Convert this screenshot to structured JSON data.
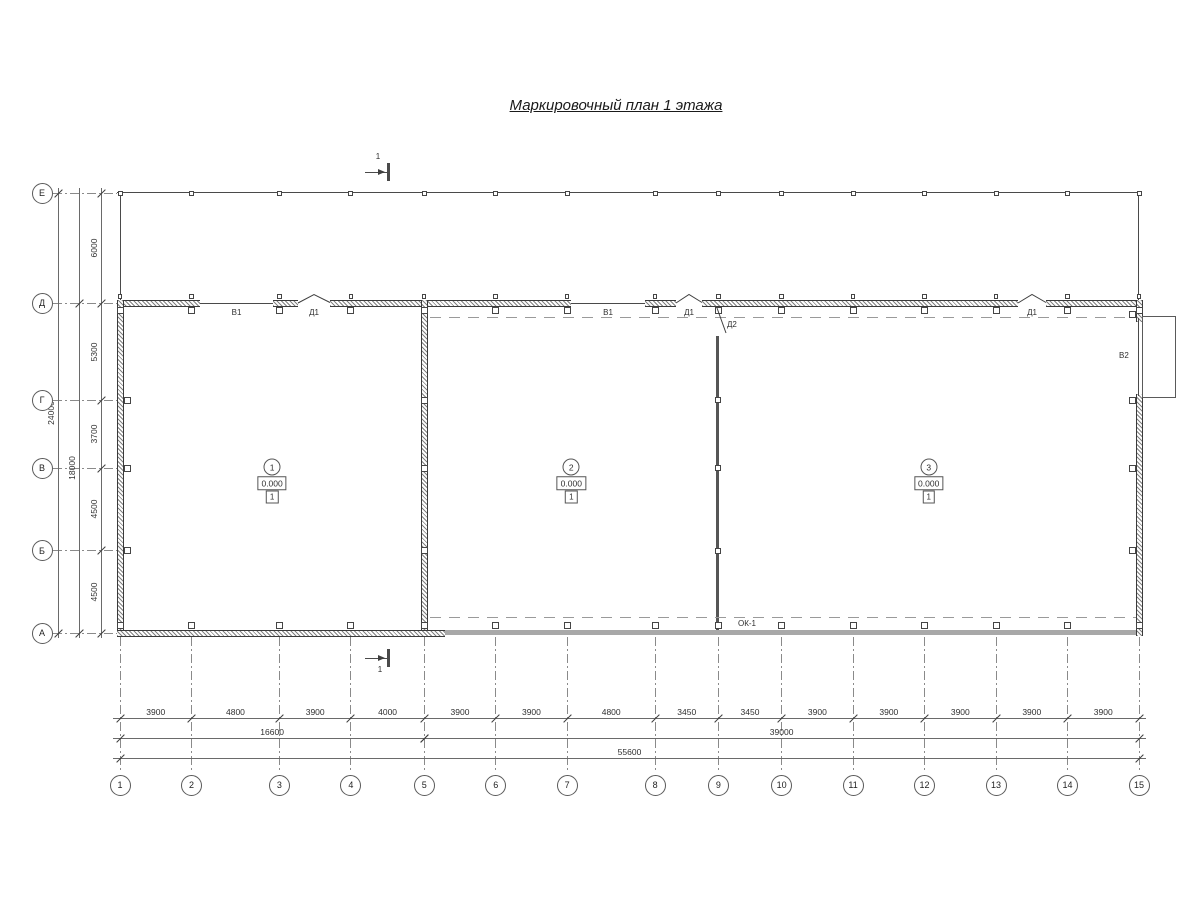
{
  "title": "Маркировочный план 1 этажа",
  "colors": {
    "ink": "#3f3f3f",
    "dim_ink": "#5a5a5a",
    "south_wall_gray": "#a8a8a8",
    "grid_dash": "#8a8a8a"
  },
  "grid": {
    "row_labels": [
      "Е",
      "Д",
      "Г",
      "В",
      "Б",
      "А"
    ],
    "column_labels": [
      "1",
      "2",
      "3",
      "4",
      "5",
      "6",
      "7",
      "8",
      "9",
      "10",
      "11",
      "12",
      "13",
      "14",
      "15"
    ]
  },
  "dimensions": {
    "column_spacings_mm": [
      3900,
      4800,
      3900,
      4000,
      3900,
      3900,
      4800,
      3450,
      3450,
      3900,
      3900,
      3900,
      3900,
      3900
    ],
    "row_spacings_mm": [
      6000,
      5300,
      3700,
      4500,
      4500
    ],
    "bottom_subtotals": [
      {
        "value": 16600,
        "from_col": "1",
        "to_col": "5"
      },
      {
        "value": 39000,
        "from_col": "5",
        "to_col": "15"
      }
    ],
    "bottom_total": {
      "value": 55600,
      "from_col": "1",
      "to_col": "15"
    },
    "left_subtotals": [
      {
        "value": 18000,
        "from_row": "Д",
        "to_row": "А"
      }
    ],
    "left_total": {
      "value": 24000,
      "from_row": "Е",
      "to_row": "А"
    }
  },
  "rooms": [
    {
      "number": "1",
      "elevation": "0.000",
      "floor_type": "1"
    },
    {
      "number": "2",
      "elevation": "0.000",
      "floor_type": "1"
    },
    {
      "number": "3",
      "elevation": "0.000",
      "floor_type": "1"
    }
  ],
  "openings": {
    "window_labels": [
      "В1",
      "В1"
    ],
    "door_labels": [
      "Д1",
      "Д1",
      "Д1"
    ],
    "inner_door_label": "Д2",
    "gate_label": "В2",
    "ribbon_window_label": "ОК-1"
  },
  "section_marks": [
    {
      "label": "1"
    },
    {
      "label": "1"
    }
  ]
}
